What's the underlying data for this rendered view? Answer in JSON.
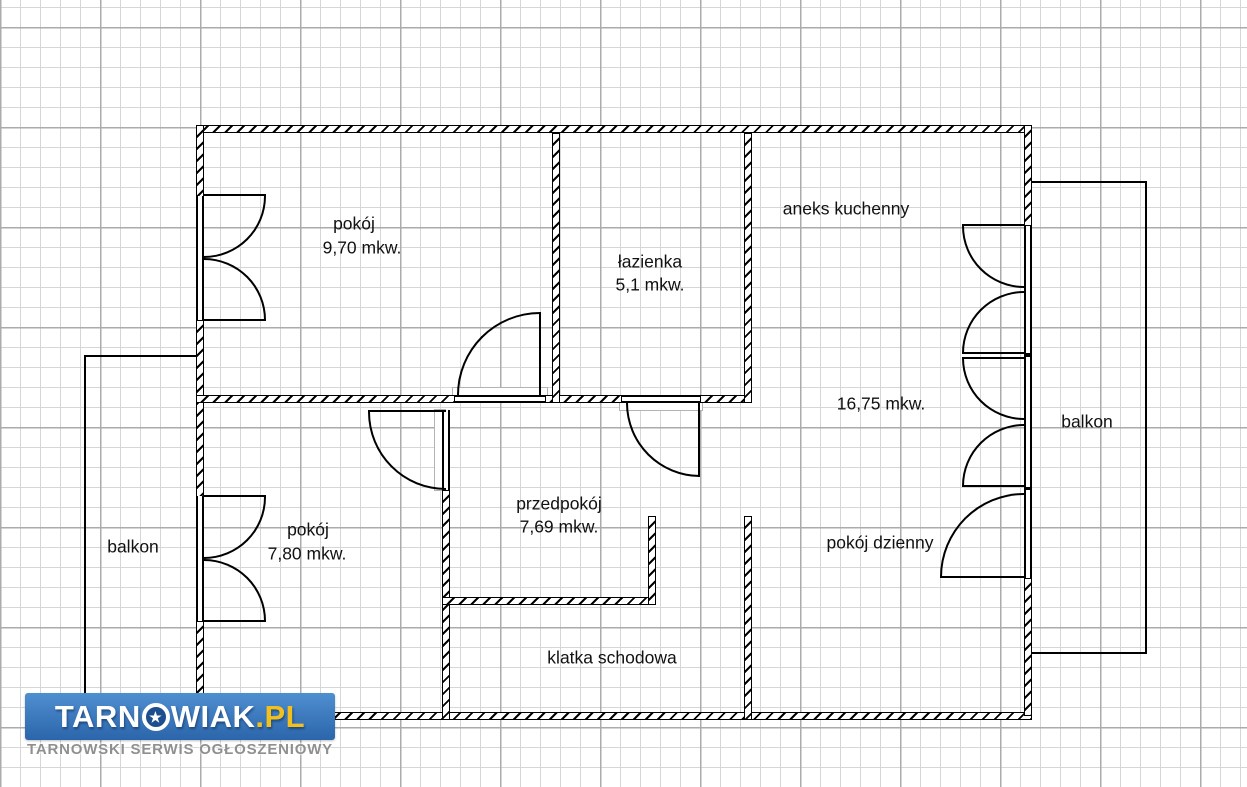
{
  "plan": {
    "rooms": {
      "pokoj_top": {
        "name": "pokój",
        "area": "9,70 mkw."
      },
      "lazienka": {
        "name": "łazienka",
        "area": "5,1 mkw."
      },
      "aneks_kuchenny": {
        "name": "aneks kuchenny"
      },
      "salon_area": {
        "area": "16,75 mkw."
      },
      "pokoj_bottom": {
        "name": "pokój",
        "area": "7,80 mkw."
      },
      "przedpokoj": {
        "name": "przedpokój",
        "area": "7,69 mkw."
      },
      "pokoj_dzienny": {
        "name": "pokój dzienny"
      },
      "klatka_schodowa": {
        "name": "klatka schodowa"
      },
      "balkon_left": {
        "name": "balkon"
      },
      "balkon_right": {
        "name": "balkon"
      }
    }
  },
  "watermark": {
    "brand_prefix": "TARN",
    "brand_star": "★",
    "brand_suffix": "WIAK",
    "brand_tld": ".PL",
    "tagline": "TARNOWSKI SERWIS OGŁOSZENIOWY",
    "colors": {
      "banner_top": "#4f8fd0",
      "banner_bottom": "#2b65ab",
      "tld_yellow": "#f2c01e",
      "tagline_gray": "#8f8f8f"
    }
  }
}
